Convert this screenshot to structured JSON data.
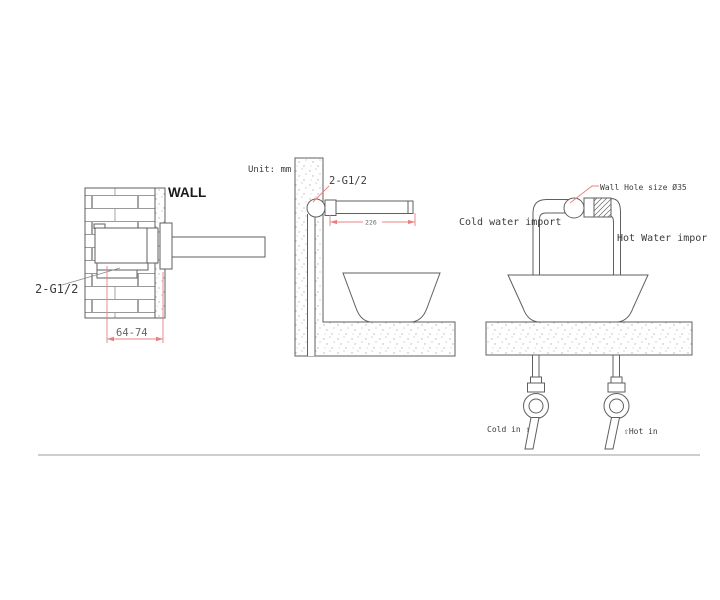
{
  "unit_label": "Unit: mm",
  "section_view": {
    "wall_label": "WALL",
    "thread_label": "2-G1/2",
    "depth_dim": "64-74"
  },
  "side_view": {
    "thread_label": "2-G1/2",
    "spout_dim": "226"
  },
  "front_view": {
    "wall_hole_label": "Wall Hole size Ø35",
    "cold_import_label": "Cold water import",
    "hot_import_label": "Hot Water impor",
    "cold_in_label": "Cold in ⇧",
    "hot_in_label": "⇧Hot in"
  },
  "colors": {
    "line": "#5f5f5f",
    "dimension_red": "#e88080",
    "text": "#3c3c3c"
  }
}
